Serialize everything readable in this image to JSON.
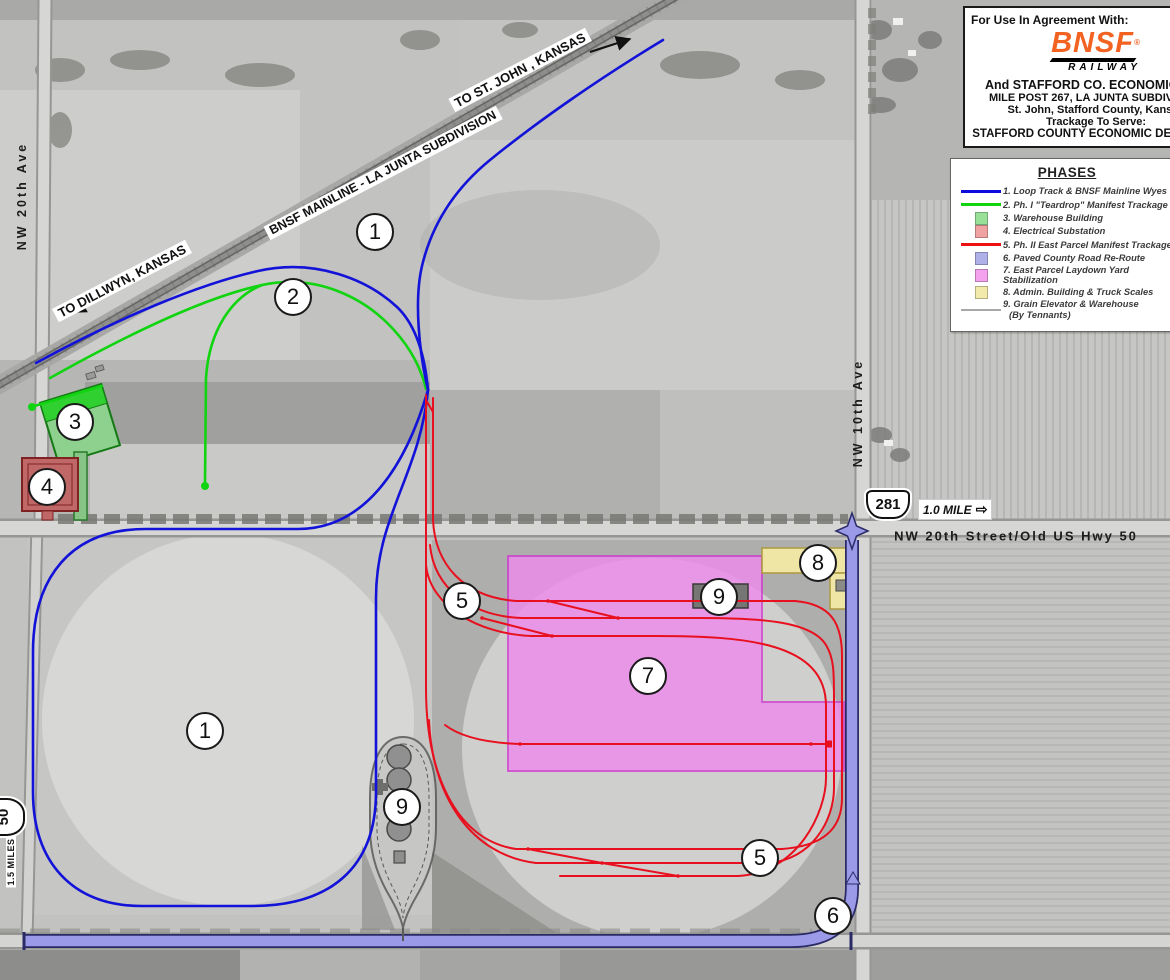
{
  "title_block": {
    "heading": "For Use In Agreement With:",
    "bnsf": "BNSF",
    "registered": "®",
    "railway": "RAILWAY",
    "lines": [
      "And STAFFORD CO. ECONOMIC DEV",
      "MILE POST 267, LA JUNTA SUBDIVISION",
      "St. John, Stafford County, Kansas",
      "Trackage To Serve:",
      "STAFFORD COUNTY ECONOMIC DEVELOPM"
    ]
  },
  "legend": {
    "title": "PHASES",
    "items": [
      {
        "swatch": "line",
        "color": "#0c0cdc",
        "thickness": 3,
        "label": "1. Loop Track & BNSF Mainline Wyes"
      },
      {
        "swatch": "line",
        "color": "#11d411",
        "thickness": 3,
        "label": "2. Ph. I \"Teardrop\" Manifest Trackage"
      },
      {
        "swatch": "square",
        "color": "#98e098",
        "label": "3. Warehouse Building"
      },
      {
        "swatch": "square",
        "color": "#f0a2a2",
        "label": "4. Electrical Substation"
      },
      {
        "swatch": "line",
        "color": "#ee1111",
        "thickness": 3,
        "label": "5. Ph. II East Parcel Manifest Trackage"
      },
      {
        "swatch": "square",
        "color": "#b0b0e8",
        "label": "6. Paved County Road Re-Route"
      },
      {
        "swatch": "square",
        "color": "#f4a2ee",
        "label": "7. East Parcel Laydown Yard Stabilization"
      },
      {
        "swatch": "square",
        "color": "#f1eaaa",
        "label": "8. Admin. Building & Truck Scales"
      },
      {
        "swatch": "line",
        "color": "#a8a8a8",
        "thickness": 2,
        "label": "9. Grain Elevator & Warehouse",
        "label2": "(By Tennants)"
      }
    ]
  },
  "map_labels": {
    "to_st_john": "TO ST. JOHN , KANSAS",
    "mainline": "BNSF MAINLINE - LA JUNTA SUBDIVISION",
    "to_dillwyn": "TO DILLWYN, KANSAS",
    "nw_20th_ave": "NW 20th Ave",
    "nw_10th_ave": "NW 10th Ave",
    "nw_20th_street": "NW 20th Street/Old US Hwy 50",
    "route_281": "281",
    "one_mile": "1.0 MILE",
    "one_mile_arrow": "⇨",
    "route_50": "50",
    "mile_1_5": "1.5 MILES"
  },
  "markers": [
    {
      "n": "1",
      "x": 375,
      "y": 232
    },
    {
      "n": "2",
      "x": 293,
      "y": 297
    },
    {
      "n": "3",
      "x": 75,
      "y": 422
    },
    {
      "n": "4",
      "x": 47,
      "y": 487
    },
    {
      "n": "1",
      "x": 205,
      "y": 731
    },
    {
      "n": "5",
      "x": 462,
      "y": 601
    },
    {
      "n": "9",
      "x": 719,
      "y": 597
    },
    {
      "n": "7",
      "x": 648,
      "y": 676
    },
    {
      "n": "8",
      "x": 818,
      "y": 563
    },
    {
      "n": "9",
      "x": 402,
      "y": 807
    },
    {
      "n": "5",
      "x": 760,
      "y": 858
    },
    {
      "n": "6",
      "x": 833,
      "y": 916
    }
  ]
}
